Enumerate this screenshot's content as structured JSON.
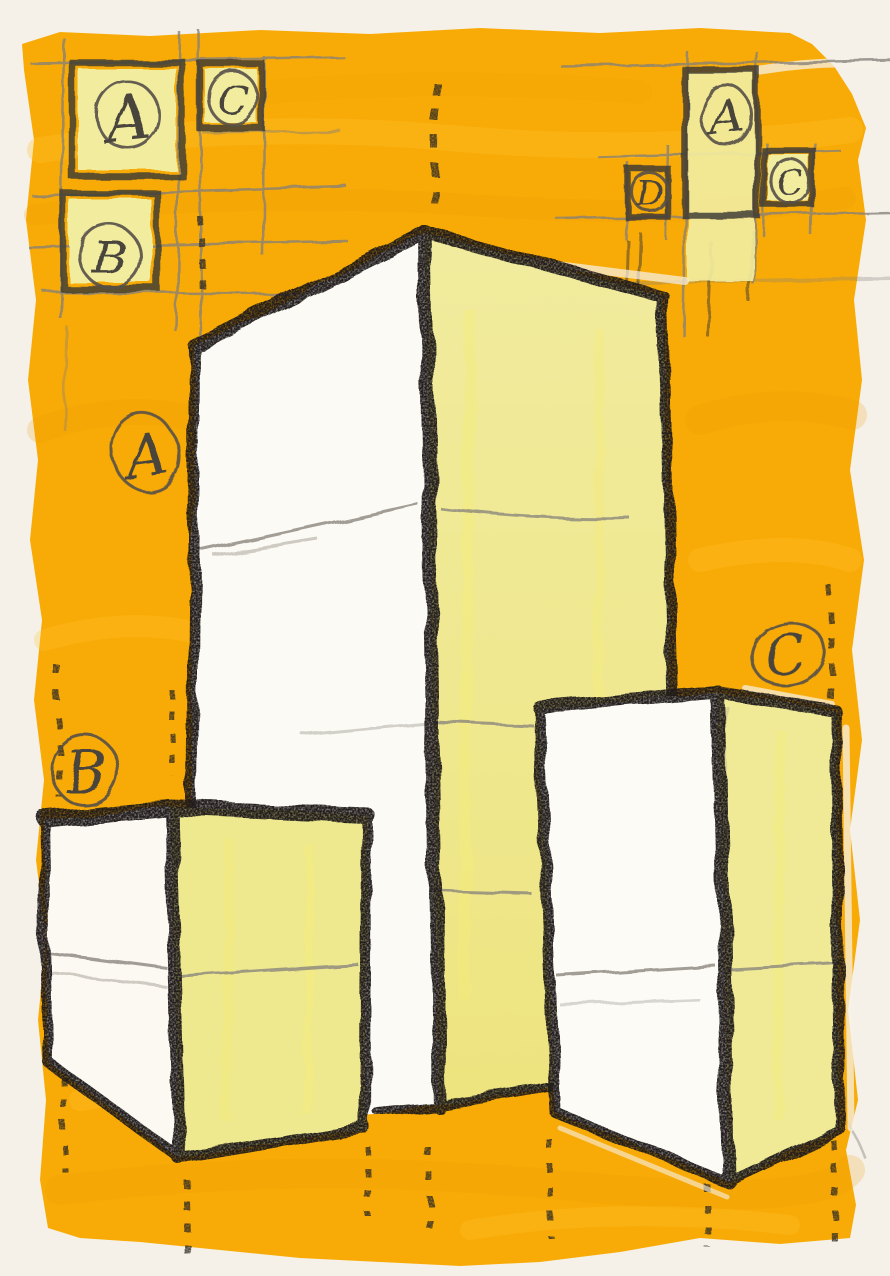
{
  "artwork": {
    "kind": "hand-drawn perspective sketch of three rectangular box volumes",
    "annotations": {
      "top_left_marks": {
        "a": "A",
        "c": "C",
        "b": "B"
      },
      "top_right_marks": {
        "a": "A",
        "d": "D",
        "c": "C"
      },
      "volume_labels": {
        "center": "A",
        "left": "B",
        "right": "C"
      }
    },
    "palette": {
      "background_paint": "#F8AB07",
      "paper": "#F5F1E8",
      "box_face_white": "#FCFAF4",
      "box_face_yellow": "#EFE993",
      "square_fill": "#F1EC9E",
      "charcoal": "#201F1C",
      "pencil": "#6B665E"
    }
  }
}
